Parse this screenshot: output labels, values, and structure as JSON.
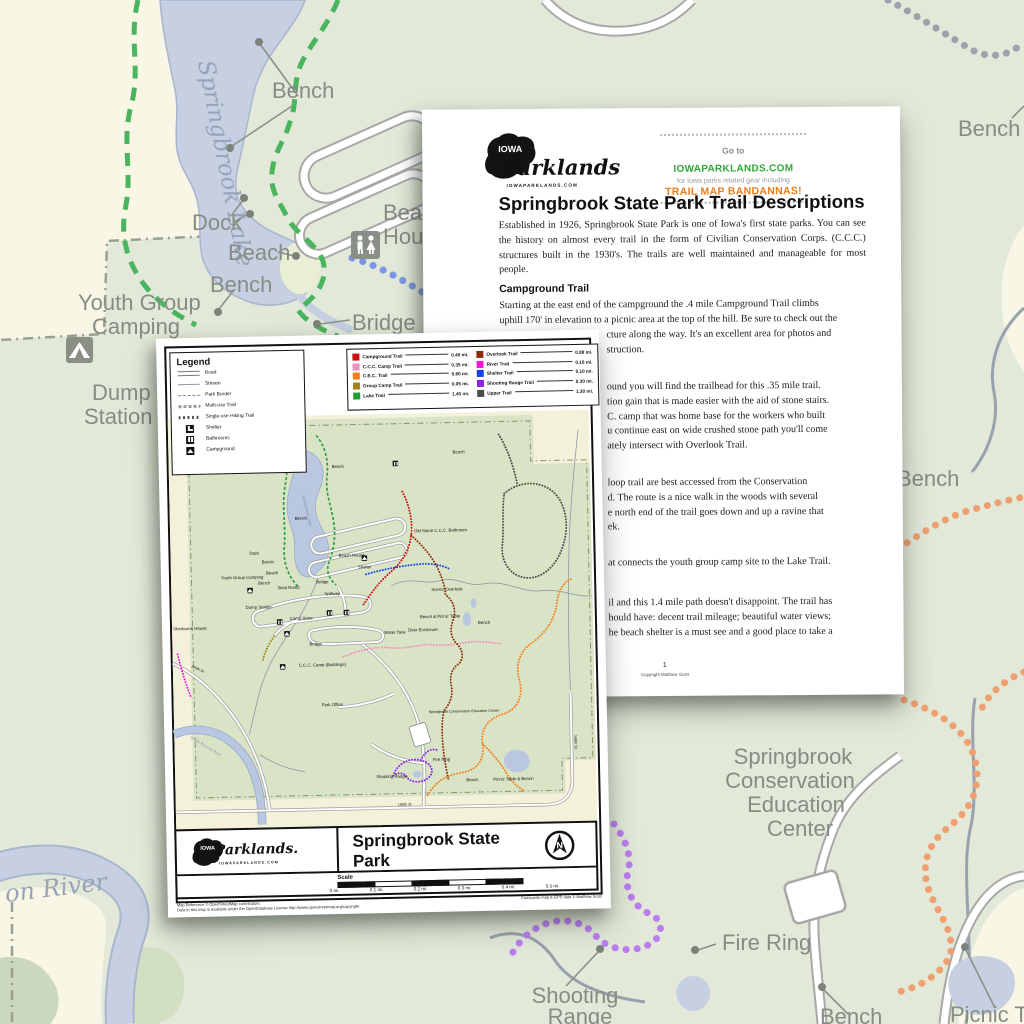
{
  "background_map": {
    "colors": {
      "park_green": "#e2e9d9",
      "outside_cream": "#f8f6e4",
      "water": "#c6d0e2",
      "road_casing": "#a8a8a8",
      "label_gray": "#878c83",
      "trail_green": "#4ab55e",
      "trail_blue": "#7b96e8",
      "trail_gray": "#9aa2ac",
      "trail_orange": "#f0a070",
      "trail_purple": "#bb7df0"
    },
    "labels": [
      "Springbrook Lake",
      "Bench",
      "Dock",
      "Beach",
      "Bench",
      "Youth Group",
      "Camping",
      "Dump",
      "Station",
      "Bridge",
      "Beach",
      "House",
      "Bench",
      "Bench",
      "Springbrook",
      "Conservation",
      "Education",
      "Center",
      "Fire Ring",
      "Shooting",
      "Range",
      "Picnic Ta",
      "Bench",
      "on River"
    ]
  },
  "doc_page": {
    "logo": {
      "iowa": "IOWA",
      "name": "Parklands",
      "domain": "IOWAPARKLANDS.COM"
    },
    "promo": {
      "go_to": "Go to",
      "site": "IOWAPARKLANDS.COM",
      "gear": "for Iowa parks related gear including",
      "bandannas": "TRAIL MAP BANDANNAS!"
    },
    "title": "Springbrook State Park Trail Descriptions",
    "p1": "Established in 1926, Springbrook State Park is one of Iowa's first state parks. You can see the history on almost every trail in the form of Civilian Conservation Corps. (C.C.C.) structures built in the 1930's. The trails are well maintained and manageable for most people.",
    "h2": "Campground Trail",
    "p2_line1": "Starting at the east end of the campground the .4 mile Campground Trail climbs",
    "p2_line2": "uphill 170' in elevation to a picnic area at the top of the hill. Be sure to check out the",
    "p2_frags": [
      "cture along the way. It's an excellent area for photos and",
      "struction."
    ],
    "frags_trail2": [
      "ound you will find the trailhead for this .35 mile trail.",
      "tion gain that is made easier with the aid of stone stairs.",
      "C. camp that was home base for the workers who built",
      "u continue east on wide crushed stone path you'll come",
      "ately intersect with Overlook Trail."
    ],
    "frags_trail3": [
      "loop trail are best accessed from the Conservation",
      "d. The route is a nice walk in the woods with several",
      "e north end of the trail goes down and up a ravine that",
      "ek."
    ],
    "frags_trail4": [
      "at connects the youth group camp site to the Lake Trail."
    ],
    "frags_trail5": [
      "il and this 1.4 mile path doesn't disappoint. The trail has",
      "hould have: decent trail mileage; beautiful water views;",
      "he beach shelter is a must see and a good place to take a"
    ],
    "page_number": "1",
    "copyright": "Copyright Matthew Scott"
  },
  "map_page": {
    "logo": {
      "iowa": "IOWA",
      "name": "Parklands.",
      "domain": "IOWAPARKLANDS.COM"
    },
    "legend": {
      "title": "Legend",
      "items": [
        "Road",
        "Stream",
        "Park Border",
        "Multi-use Trail",
        "Single-use Hiking Trail",
        "Shelter",
        "Bathrooms",
        "Campground"
      ]
    },
    "trails": [
      {
        "name": "Campground Trail",
        "len": "0.40 mi.",
        "color": "#cc1111"
      },
      {
        "name": "C.C.C. Camp Trail",
        "len": "0.35 mi.",
        "color": "#f490bc"
      },
      {
        "name": "C.E.C. Trail",
        "len": "0.90 mi.",
        "color": "#f57d1a"
      },
      {
        "name": "Group Camp Trail",
        "len": "0.05 mi.",
        "color": "#a3841a"
      },
      {
        "name": "Lake Trail",
        "len": "1.40 mi.",
        "color": "#1e9e30"
      },
      {
        "name": "Overlook Trail",
        "len": "0.89 mi.",
        "color": "#8f2c0a"
      },
      {
        "name": "River Trail",
        "len": "0.10 mi.",
        "color": "#f318d8"
      },
      {
        "name": "Shelter Trail",
        "len": "0.10 mi.",
        "color": "#1741e8"
      },
      {
        "name": "Shooting Range Trail",
        "len": "0.30 mi.",
        "color": "#8e22e8"
      },
      {
        "name": "Upper Trail",
        "len": "1.30 mi.",
        "color": "#4b4b4b"
      }
    ],
    "title": "Springbrook State Park",
    "subtitle": "Guthrie County, Iowa",
    "north": "N",
    "scale_label": "Scale",
    "scale_ticks": [
      "0 mi.",
      "0.1 mi.",
      "0.2 mi.",
      "0.3 mi.",
      "0.4 mi.",
      "0.5 mi."
    ],
    "credit_line1": "Map Reference © OpenStreetMap contributors",
    "credit_line2": "Data in this map is available under the OpenDatabase License http://www.openstreetmap.org/copyright",
    "credit_right": "Composite map & GPS data © Matthew Scott",
    "map_labels": [
      "Bench",
      "Bench",
      "Bench",
      "Bench",
      "Bench",
      "Bench",
      "Bench",
      "Bench",
      "Dock",
      "Beach",
      "Beach House",
      "Bridge",
      "Shelter",
      "Spillway",
      "Boat Ramp",
      "Youth Group Camping",
      "Dump Station",
      "Camp Store",
      "Bridge",
      "C.C.C. Camp (Buildings)",
      "Park Office",
      "Sherburne House",
      "Old Stone C.C.C. Bathroom",
      "Scenic Overlook",
      "Bench & Picnic Table",
      "Deer Enclosure",
      "Water Tank",
      "Springbrook Conservation Education Center",
      "Fire Ring",
      "Shooting Range",
      "Picnic Table & Bench",
      "160th St",
      "165th St",
      "146th St",
      "Springbrook Lake",
      "Middle Raccoon River"
    ]
  }
}
